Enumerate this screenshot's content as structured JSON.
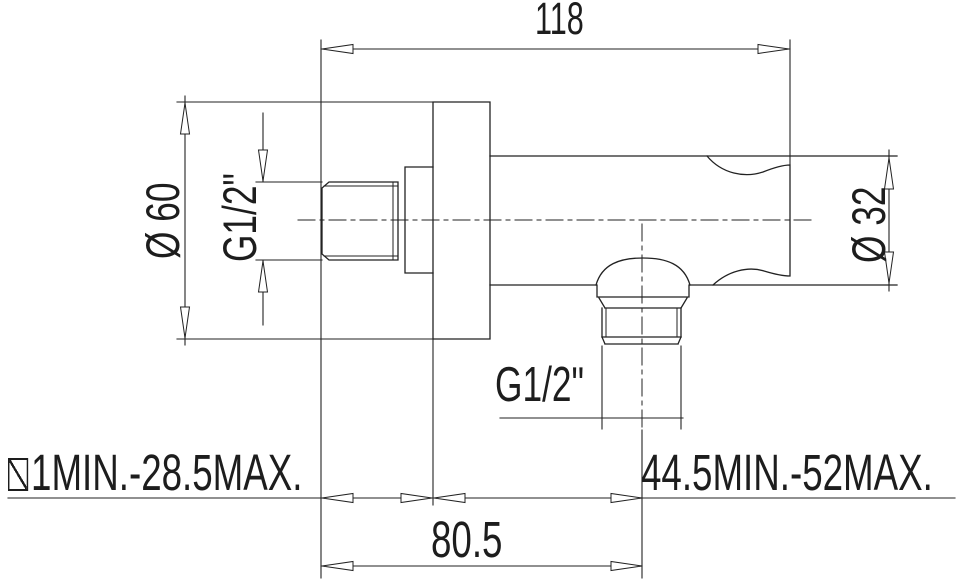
{
  "drawing": {
    "colors": {
      "line": "#222222",
      "text": "#1d1d1d",
      "background": "#ffffff"
    },
    "icons": {
      "wall_depth_prefix_icon": "slashed-box-icon"
    },
    "labels": {
      "overall_length": "118",
      "flange_diameter": "Ø 60",
      "inlet_thread": "G1/2\"",
      "body_diameter": "Ø 32",
      "outlet_thread": "G1/2\"",
      "wall_depth_range": "1MIN.-28.5MAX.",
      "flange_to_outlet_range": "44.5MIN.-52MAX.",
      "thread_to_outlet_distance": "80.5"
    }
  }
}
